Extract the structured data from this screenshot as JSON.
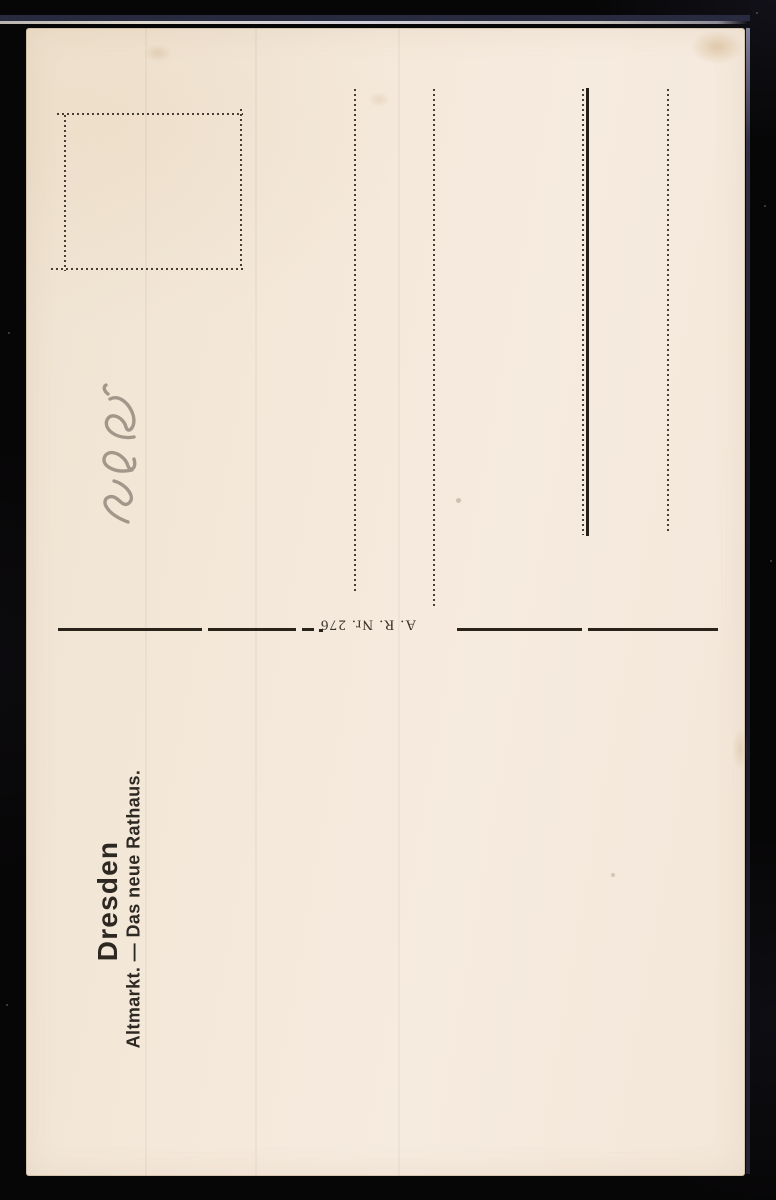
{
  "postcard": {
    "caption": {
      "title": "Dresden",
      "subtitle": "Altmarkt. — Das neue Rathaus."
    },
    "publisher_number": "A. R. Nr. 276",
    "address_rule_count": 4,
    "stamp_box_present": true
  },
  "icons": {
    "stamp_box": "dotted-stamp-frame",
    "pencil_note": "handwritten-pencil-squiggle",
    "address_rules": "dotted-vertical-address-lines"
  },
  "colors": {
    "backdrop": "#070607",
    "card_paper": "#f4e8da",
    "printed_ink": "#2a2319",
    "dotted_rule": "#473e34",
    "pencil_graphite": "#8f8478",
    "scan_highlight": "#d3d0da",
    "scan_band_navy": "#282a40"
  }
}
